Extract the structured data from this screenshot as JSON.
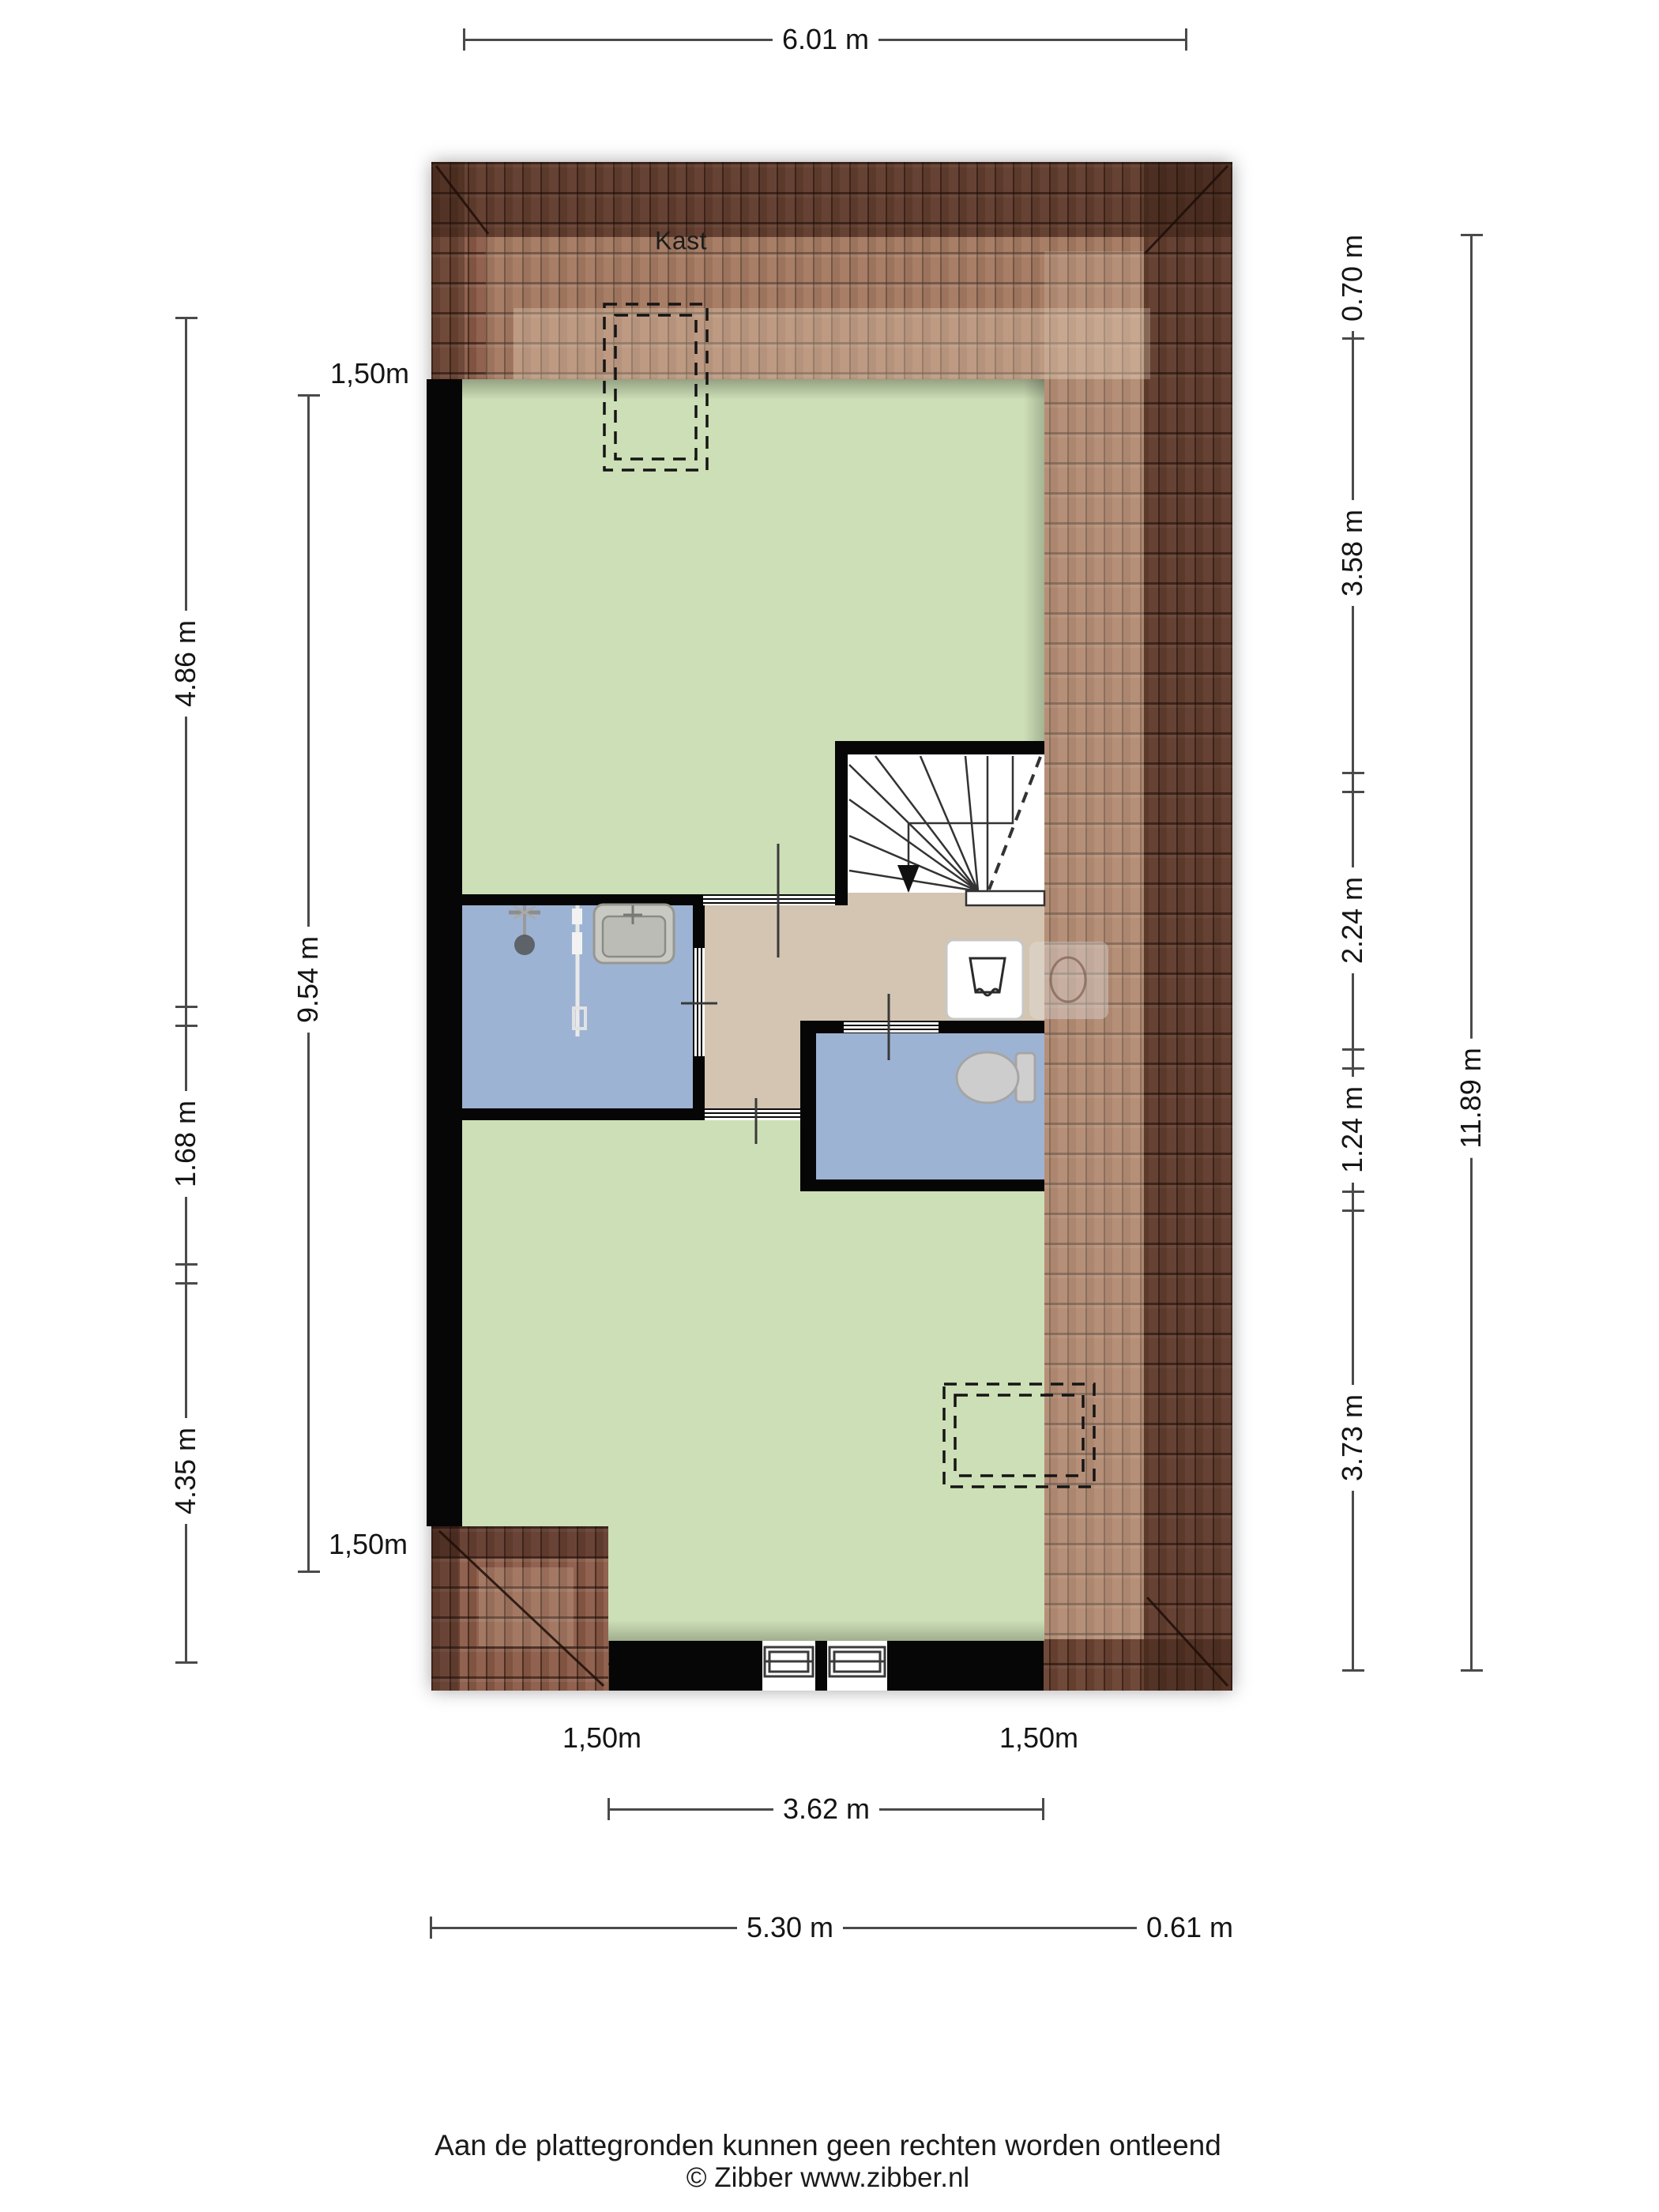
{
  "rooms": {
    "kast_label": "Kast",
    "bedroom_top_label": "Slaapkamer",
    "bathroom_label": "Badkamer",
    "landing_label": "Overloop",
    "bedroom_bottom_label": "Slaapkamer"
  },
  "dimensions": {
    "top_width": "6.01 m",
    "left_outer_top": "4.86 m",
    "left_outer_mid": "1.68 m",
    "left_outer_bottom": "4.35 m",
    "left_inner_total": "9.54 m",
    "left_clearance_top": "1,50m",
    "left_clearance_bottom": "1,50m",
    "right_inner_1": "0.70 m",
    "right_inner_2": "3.58 m",
    "right_inner_3": "2.24 m",
    "right_inner_4": "1.24 m",
    "right_inner_5": "3.73 m",
    "right_outer_total": "11.89 m",
    "bottom_clearance_left": "1,50m",
    "bottom_clearance_right": "1,50m",
    "bottom_window_width": "3.62 m",
    "bottom_main": "5.30 m",
    "bottom_overhang": "0.61 m"
  },
  "footer": {
    "disclaimer": "Aan de plattegronden kunnen geen rechten worden ontleend",
    "copyright": "© Zibber www.zibber.nl"
  },
  "colors": {
    "roof_base": "#8a5a46",
    "roof_dark": "#5d3c30",
    "roof_light": "#b08468",
    "wall": "#060606",
    "bedroom": "#cddfb6",
    "bathroom": "#9db3d3",
    "landing": "#d3c5b1",
    "dim_line": "#4a4a4a",
    "text": "#1c1c1c"
  }
}
